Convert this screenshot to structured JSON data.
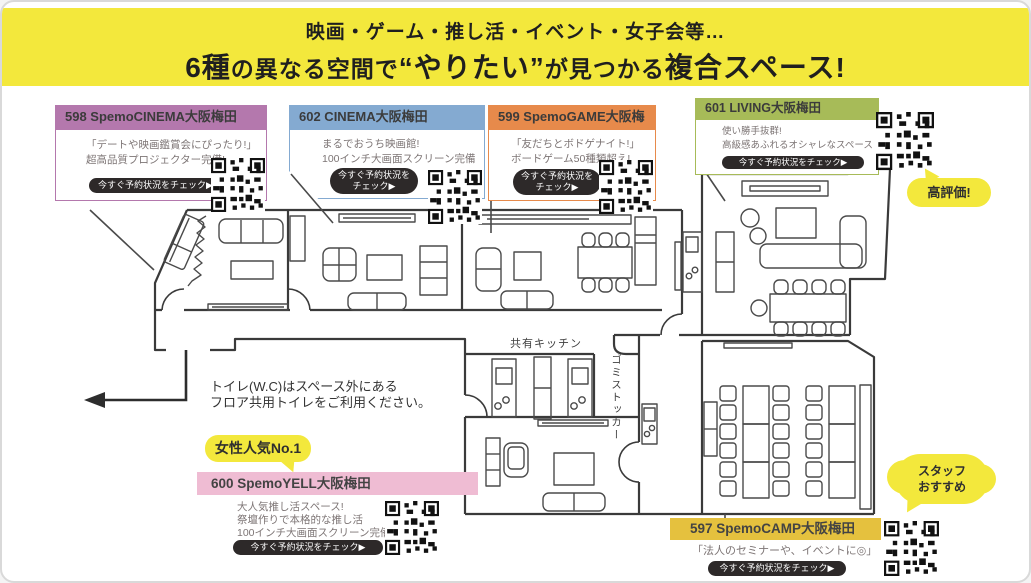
{
  "banner": {
    "line1": "映画・ゲーム・推し活・イベント・女子会等…",
    "line2_seg1": "6種",
    "line2_seg2": "の異なる空間で",
    "line2_seg3": "“やりたい”",
    "line2_seg4": "が見つかる",
    "line2_seg5": "複合スペース!"
  },
  "check_button": "今すぐ予約状況をチェック▶",
  "rooms": {
    "cinema598": {
      "title": "598 SpemoCINEMA大阪梅田",
      "line1": "「デートや映画鑑賞会にぴったり!」",
      "line2": "超高品質プロジェクター完備!",
      "accent": "#b478ad"
    },
    "cinema602": {
      "title": "602 CINEMA大阪梅田",
      "line1": "まるでおうち映画館!",
      "line2": "100インチ大画面スクリーン完備",
      "accent": "#84aad1"
    },
    "game599": {
      "title": "599 SpemoGAME大阪梅田",
      "line1": "「友だちとボドゲナイト!」",
      "line2": "ボードゲーム50種類超え!",
      "accent": "#e78a4b"
    },
    "living601": {
      "title": "601 LIVING大阪梅田",
      "line1": "使い勝手抜群!",
      "line2": "高級感あふれるオシャレなスペース",
      "accent": "#a7bb58"
    },
    "yell600": {
      "title": "600 SpemoYELL大阪梅田",
      "line1": "大人気推し活スペース!",
      "line2": "祭壇作りで本格的な推し活",
      "line3": "100インチ大画面スクリーン完備",
      "accent": "#efbcd3"
    },
    "camp597": {
      "title": "597 SpemoCAMP大阪梅田",
      "line1": "「法人のセミナーや、イベントに◎」",
      "accent": "#e5c13e"
    }
  },
  "badges": {
    "high_rating": "高評価!",
    "female_no1": "女性人気No.1",
    "staff_line1": "スタッフ",
    "staff_line2": "おすすめ"
  },
  "floorplan": {
    "note_line1": "トイレ(W.C)はスペース外にある",
    "note_line2": "フロア共用トイレをご利用ください。",
    "kitchen_label": "共有キッチン",
    "trash_label": "ゴミストッカー"
  }
}
